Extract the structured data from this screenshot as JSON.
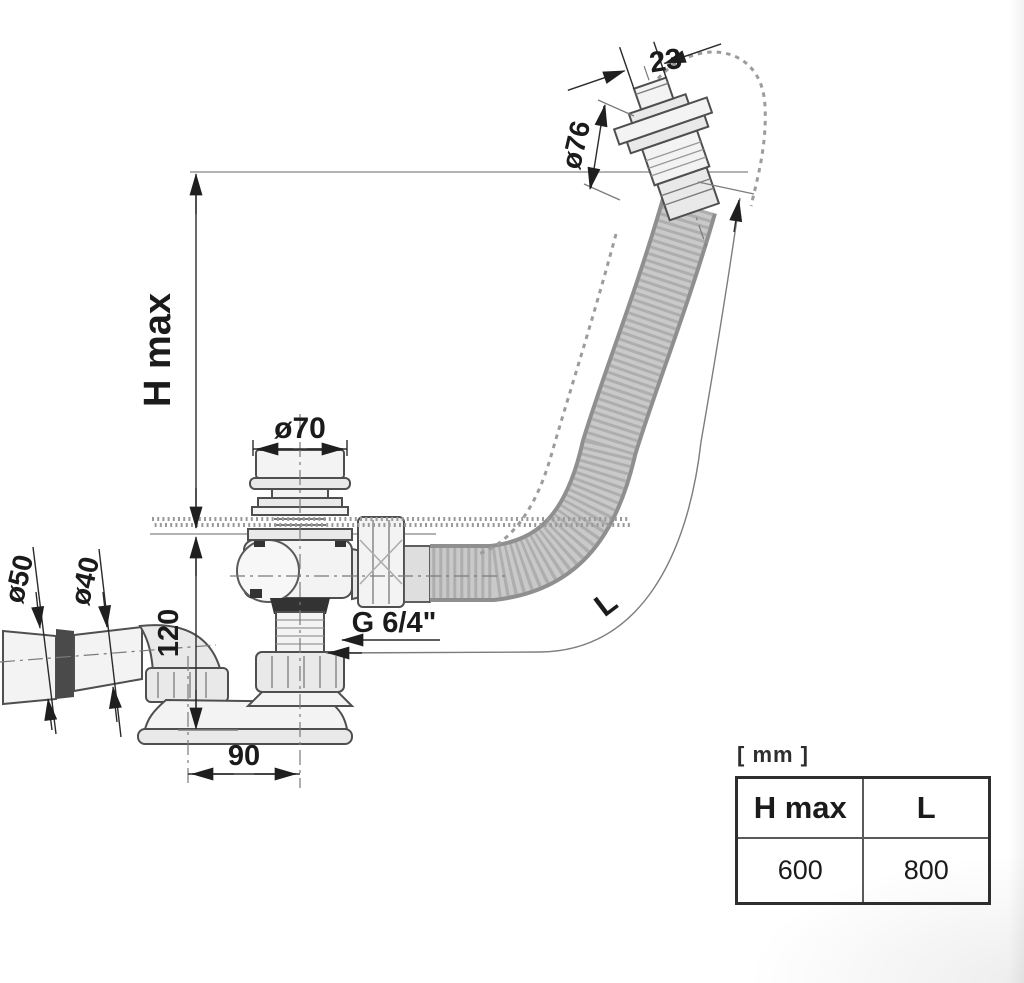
{
  "diagram": {
    "title": "Bath waste and overflow set technical drawing",
    "labels": {
      "h_max": "H max",
      "dia76": "ø76",
      "dim23": "23",
      "dia70": "ø70",
      "dia50": "ø50",
      "dia40": "ø40",
      "dim120": "120",
      "dim90": "90",
      "thread": "G 6/4\"",
      "length": "L"
    },
    "colors": {
      "line": "#4f4f4f",
      "dim": "#2b2b2b",
      "text": "#1b1b1b",
      "hose_fill": "#c9c9c9",
      "hose_edge": "#8f8f8f",
      "dark_fill": "#333333"
    }
  },
  "spec_table": {
    "unit_label": "[ mm ]",
    "columns": [
      "H max",
      "L"
    ],
    "rows": [
      [
        "600",
        "800"
      ]
    ]
  }
}
